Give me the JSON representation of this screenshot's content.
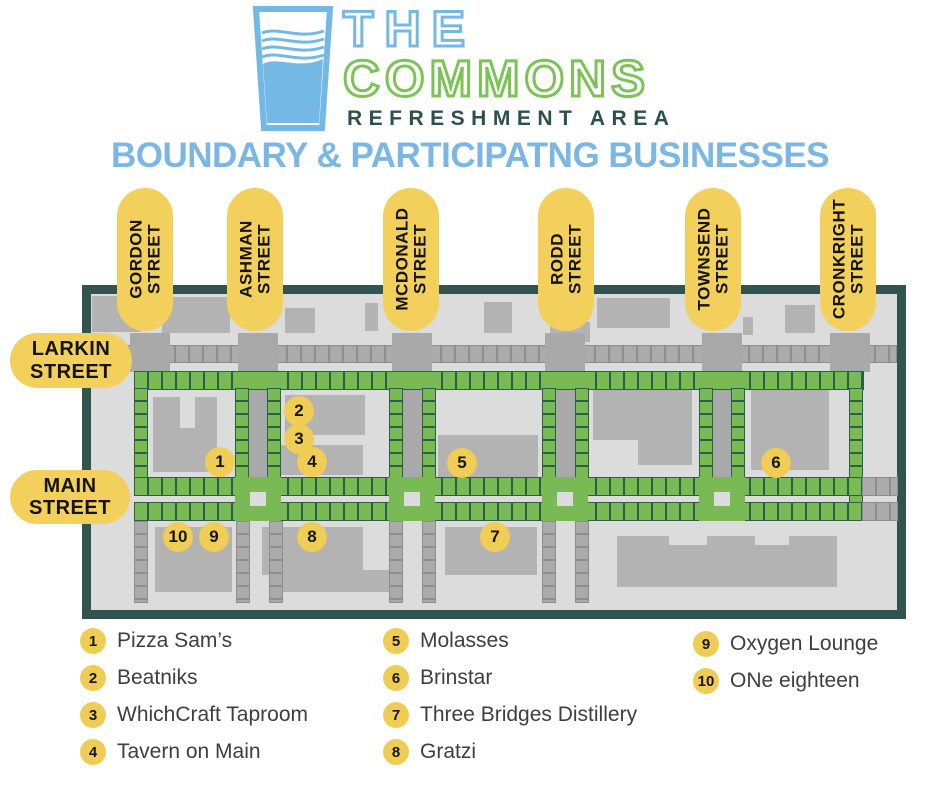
{
  "logo": {
    "line1": "THE",
    "line2": "COMMONS",
    "line3": "REFRESHMENT AREA"
  },
  "title": "BOUNDARY & PARTICIPATNG BUSINESSES",
  "streets": {
    "vertical": [
      {
        "name": "GORDON",
        "suffix": "STREET"
      },
      {
        "name": "ASHMAN",
        "suffix": "STREET"
      },
      {
        "name": "MCDONALD",
        "suffix": "STREET"
      },
      {
        "name": "RODD",
        "suffix": "STREET"
      },
      {
        "name": "TOWNSEND",
        "suffix": "STREET"
      },
      {
        "name": "CRONKRIGHT",
        "suffix": "STREET"
      }
    ],
    "horizontal": [
      {
        "name": "LARKIN",
        "suffix": "STREET"
      },
      {
        "name": "MAIN",
        "suffix": "STREET"
      }
    ]
  },
  "markers": [
    {
      "n": "1"
    },
    {
      "n": "2"
    },
    {
      "n": "3"
    },
    {
      "n": "4"
    },
    {
      "n": "5"
    },
    {
      "n": "6"
    },
    {
      "n": "7"
    },
    {
      "n": "8"
    },
    {
      "n": "9"
    },
    {
      "n": "10"
    }
  ],
  "legend": {
    "columns": [
      [
        {
          "n": "1",
          "label": "Pizza Sam’s"
        },
        {
          "n": "2",
          "label": "Beatniks"
        },
        {
          "n": "3",
          "label": "WhichCraft Taproom"
        },
        {
          "n": "4",
          "label": "Tavern on Main"
        }
      ],
      [
        {
          "n": "5",
          "label": "Molasses"
        },
        {
          "n": "6",
          "label": "Brinstar"
        },
        {
          "n": "7",
          "label": "Three Bridges Distillery"
        },
        {
          "n": "8",
          "label": "Gratzi"
        }
      ],
      [
        {
          "n": "9",
          "label": "Oxygen Lounge"
        },
        {
          "n": "10",
          "label": "ONe eighteen"
        }
      ]
    ]
  },
  "colors": {
    "logo_blue": "#74b9e5",
    "logo_green": "#7cc356",
    "teal_dark": "#2d504c",
    "title_blue": "#7cb7e3",
    "pill_yellow": "#f2d05b",
    "marker_yellow": "#f0cd54",
    "map_border": "#315450",
    "map_background": "#dcdcdc",
    "building_gray": "#b3b3b3",
    "street_gray": "#ababab",
    "boundary_green": "#7aba55"
  }
}
